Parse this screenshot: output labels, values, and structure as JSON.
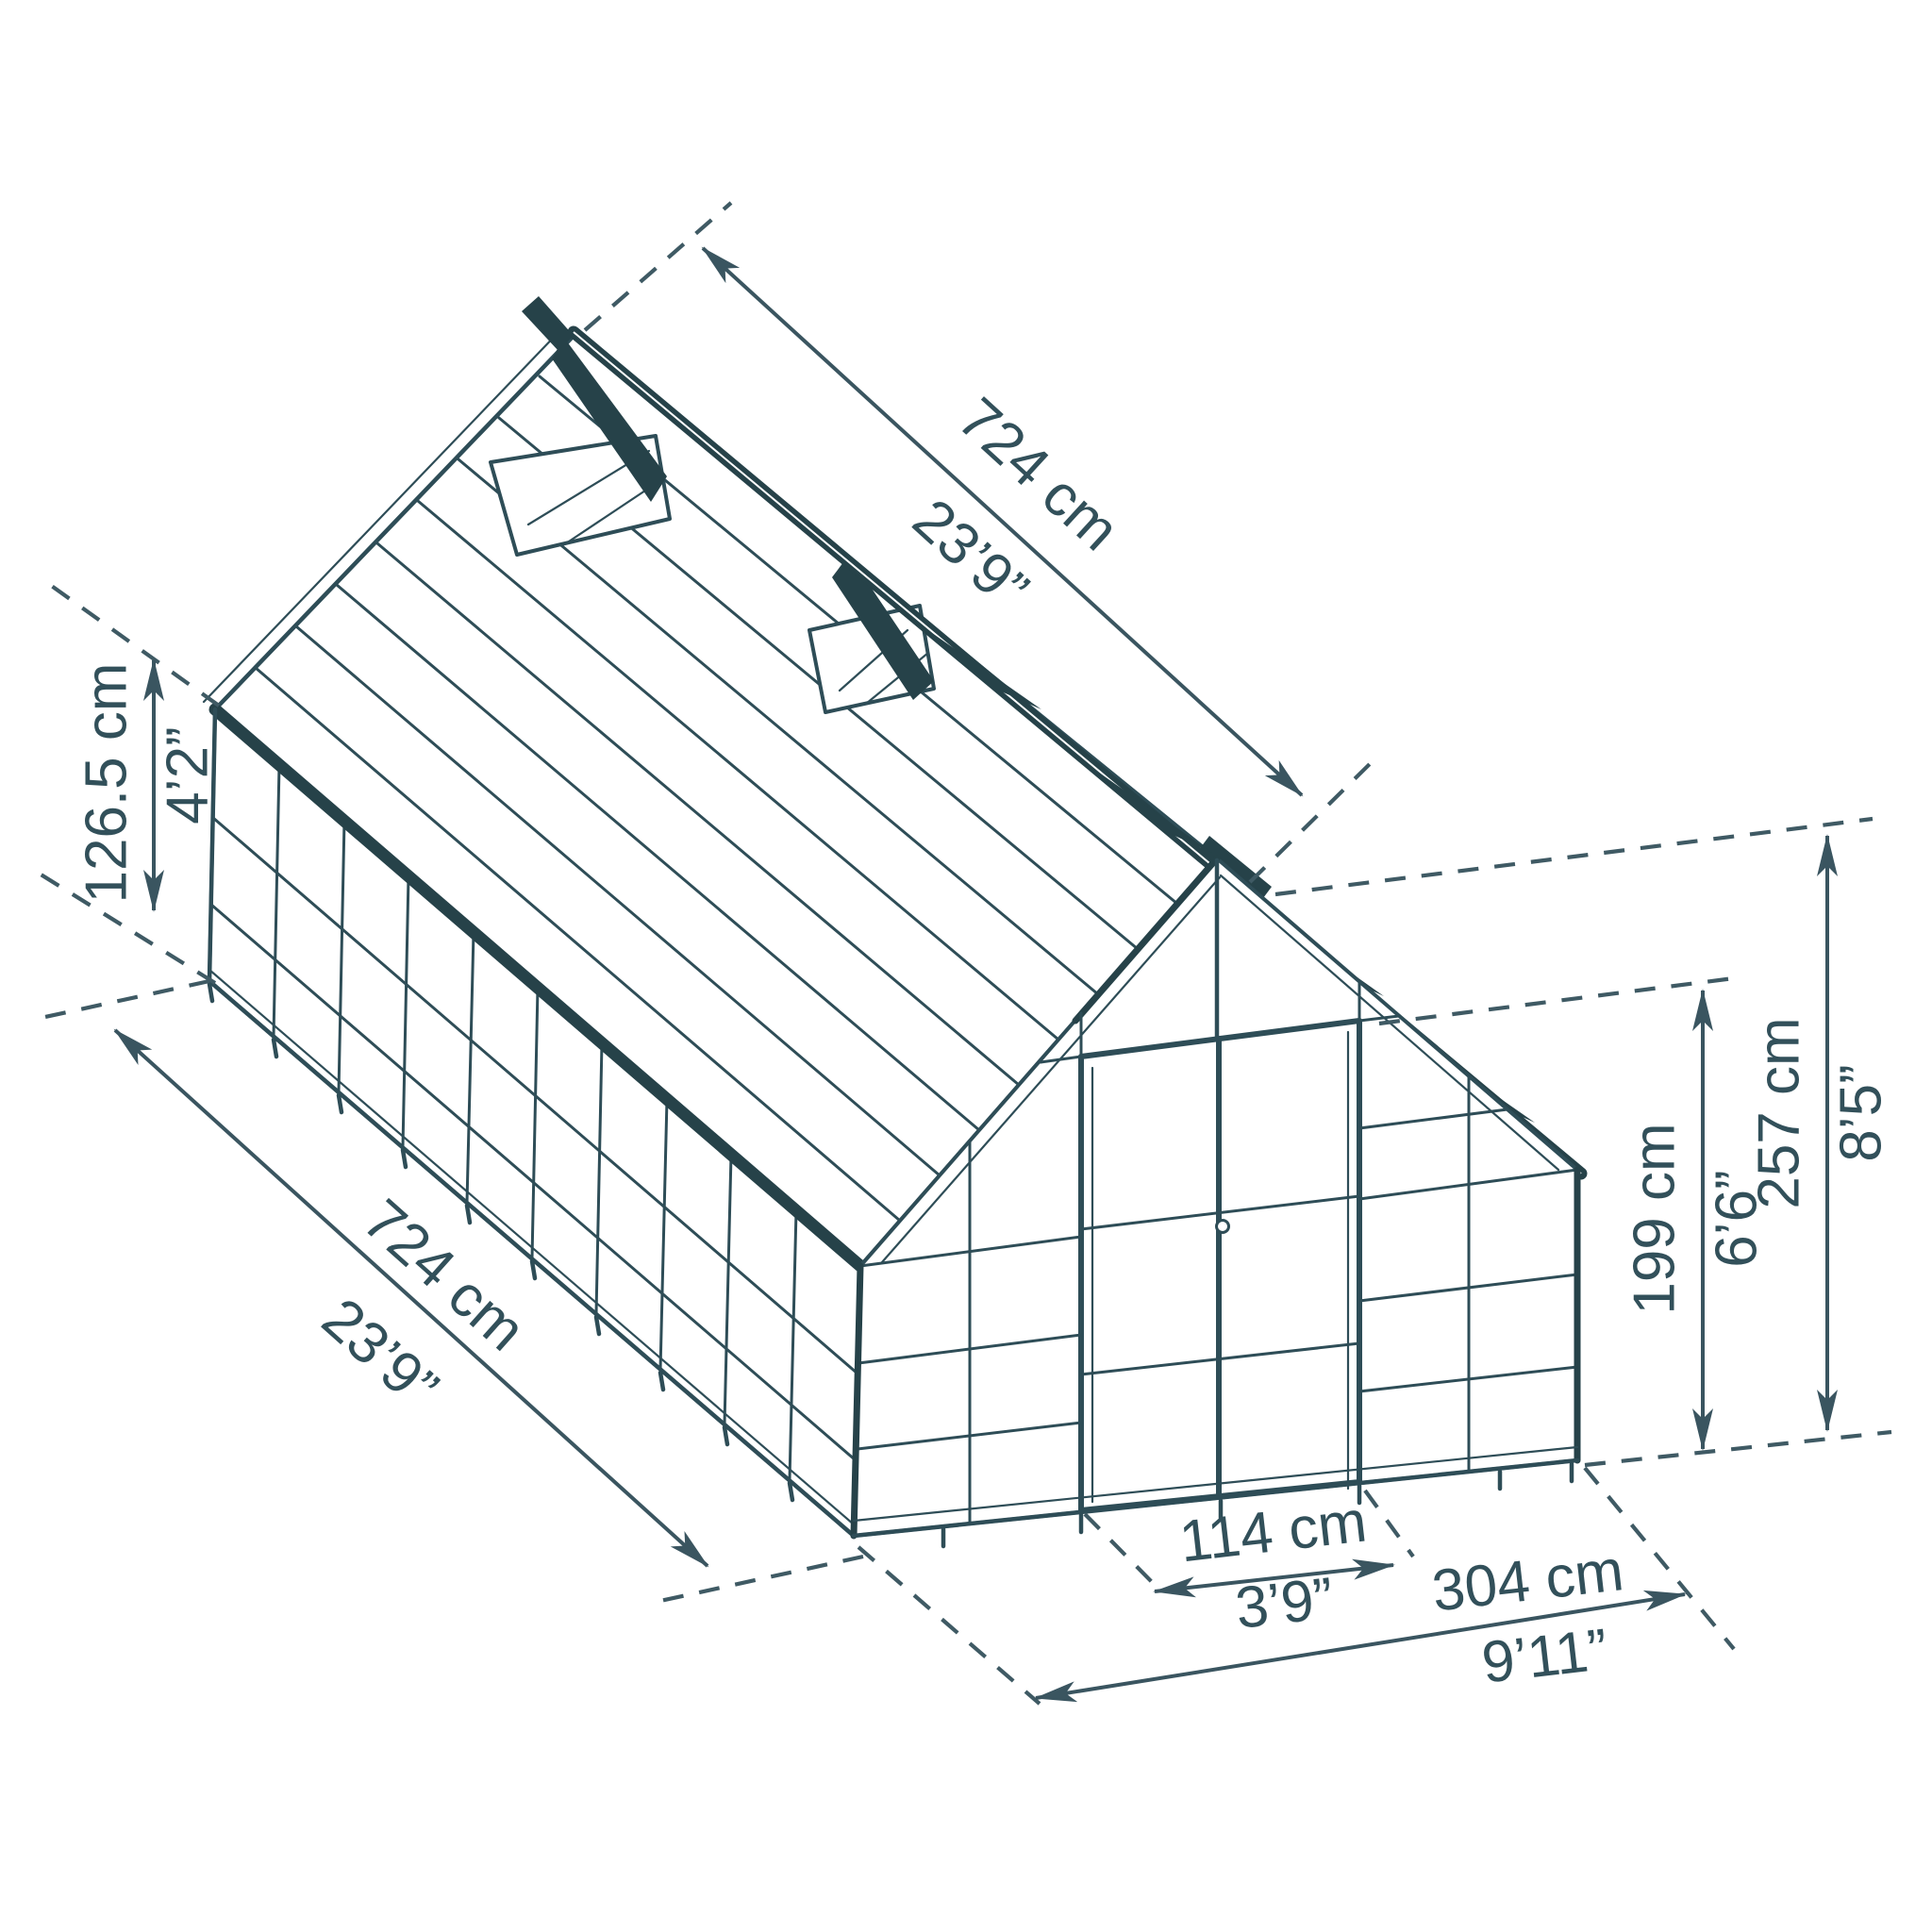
{
  "diagram": {
    "kind": "greenhouse-isometric-dimension-drawing",
    "colors": {
      "line": "#2e4d57",
      "dark_frame": "#264249",
      "text": "#32505a",
      "background": "#ffffff"
    },
    "dimensions": {
      "ridge_length": {
        "metric": "724 cm",
        "imperial": "23’9”"
      },
      "side_length": {
        "metric": "724 cm",
        "imperial": "23’9”"
      },
      "eave_to_ridge": {
        "metric": "126.5 cm",
        "imperial": "4’2”"
      },
      "total_height": {
        "metric": "257 cm",
        "imperial": "8’5”"
      },
      "wall_height": {
        "metric": "199 cm",
        "imperial": "6’6”"
      },
      "door_width": {
        "metric": "114 cm",
        "imperial": "3’9”"
      },
      "front_width": {
        "metric": "304 cm",
        "imperial": "9’11”"
      }
    }
  }
}
